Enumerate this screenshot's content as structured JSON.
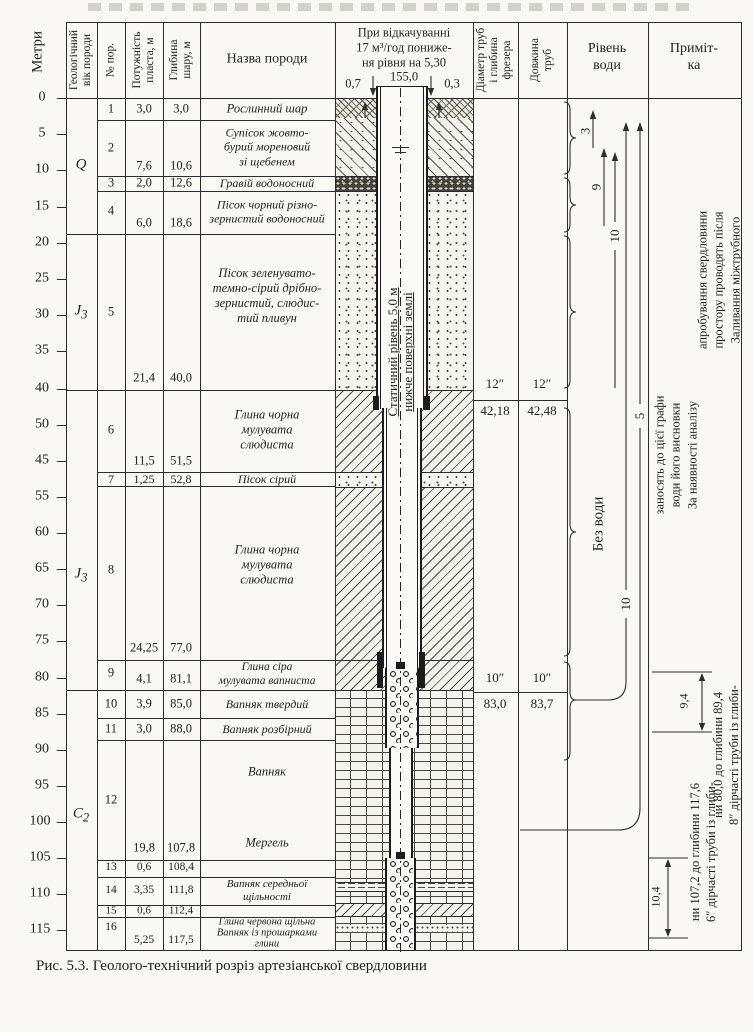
{
  "figure": {
    "caption": "Рис. 5.3. Геолого-технічний розріз артезіанської свердловини"
  },
  "header": {
    "meters": "Метри",
    "geo_age": "Геологічний\nвік породи",
    "no": "№ пор.",
    "thickness": "Потужність\nпласта, м",
    "depth": "Глибина\nшару, м",
    "rock_name": "Назва породи",
    "pumping": "При відкачуванні\n17 м³/год пониже-\nня рівня на 5,30",
    "pipe_diam": "Діаметр труб\nі глибина\nфрезера",
    "pipe_len": "Довжина\nтруб",
    "water_level": "Рівень\nводи",
    "note": "Приміт-\nка"
  },
  "scale": [
    "0",
    "5",
    "10",
    "15",
    "20",
    "25",
    "30",
    "35",
    "40",
    "50",
    "45",
    "55",
    "60",
    "65",
    "70",
    "75",
    "80",
    "85",
    "90",
    "95",
    "100",
    "105",
    "110",
    "115"
  ],
  "ages": [
    {
      "main": "Q",
      "sub": ""
    },
    {
      "main": "J",
      "sub": "3"
    },
    {
      "main": "J",
      "sub": "3"
    },
    {
      "main": "C",
      "sub": "2"
    }
  ],
  "rows": [
    {
      "no": "1",
      "thick": "3,0",
      "depth": "3,0",
      "name": "Рослинний шар"
    },
    {
      "no": "2",
      "thick": "7,6",
      "depth": "10,6",
      "name": "Супісок жовто-\nбурий мореновий\nзі щебенем"
    },
    {
      "no": "3",
      "thick": "2,0",
      "depth": "12,6",
      "name": "Гравій водоносний"
    },
    {
      "no": "4",
      "thick": "6,0",
      "depth": "18,6",
      "name": "Пісок чорний різно-\nзернистий водоносний"
    },
    {
      "no": "5",
      "thick": "21,4",
      "depth": "40,0",
      "name": "Пісок зеленувато-\nтемно-сірий дрібно-\nзернистий, слюдис-\nтий пливун"
    },
    {
      "no": "6",
      "thick": "11,5",
      "depth": "51,5",
      "name": "Глина чорна\nмулувата\nслюдиста"
    },
    {
      "no": "7",
      "thick": "1,25",
      "depth": "52,8",
      "name": "Пісок сірий"
    },
    {
      "no": "8",
      "thick": "24,25",
      "depth": "77,0",
      "name": "Глина чорна\nмулувата\nслюдиста"
    },
    {
      "no": "9",
      "thick": "4,1",
      "depth": "81,1",
      "name": "Глина сіра\nмулувата вапниста"
    },
    {
      "no": "10",
      "thick": "3,9",
      "depth": "85,0",
      "name": "Вапняк твердий"
    },
    {
      "no": "11",
      "thick": "3,0",
      "depth": "88,0",
      "name": "Вапняк розбірний"
    },
    {
      "no": "12",
      "thick": "19,8",
      "depth": "107,8",
      "name": "Вапняк",
      "name2": "Мергель"
    },
    {
      "no": "13",
      "thick": "0,6",
      "depth": "108,4",
      "name": ""
    },
    {
      "no": "14",
      "thick": "3,35",
      "depth": "111,8",
      "name": "Вапняк середньої\nщільності"
    },
    {
      "no": "15",
      "thick": "0,6",
      "depth": "112,4",
      "name": ""
    },
    {
      "no": "16",
      "thick": "5,25",
      "depth": "117,5",
      "name": "Глина червона щільна\nВапняк із прошарками\nглини"
    }
  ],
  "borehole": {
    "top_left": "0,7",
    "top_center": "155,0",
    "top_right": "0,3",
    "static": "Статичний рівень 5,0 м\nнижче поверхні землі"
  },
  "casing": {
    "d12a": "12″",
    "d12b": "12″",
    "l42a": "42,18",
    "l42b": "42,48",
    "d10a": "10″",
    "d10b": "10″",
    "l83a": "83,0",
    "l83b": "83,7"
  },
  "water": {
    "a3": "3",
    "a9": "9",
    "a10a": "10",
    "a10b": "10",
    "a5": "5",
    "no_water": "Без води"
  },
  "notes": {
    "n1": [
      "Заливання міжтрубного",
      "простору проводять після",
      "апробування свердловини"
    ],
    "n2": [
      "За наявності аналізу",
      "води його висновки",
      "заносять до цієї графи"
    ],
    "n3": [
      "8″ дірчасті труби із глиби-",
      "ни 80,0 до глибини 89,4"
    ],
    "n4": [
      "6″ дірчасті труби із глиби-",
      "ни 107,2 до глибини 117,6"
    ],
    "d94": "9,4",
    "d104": "10,4"
  }
}
